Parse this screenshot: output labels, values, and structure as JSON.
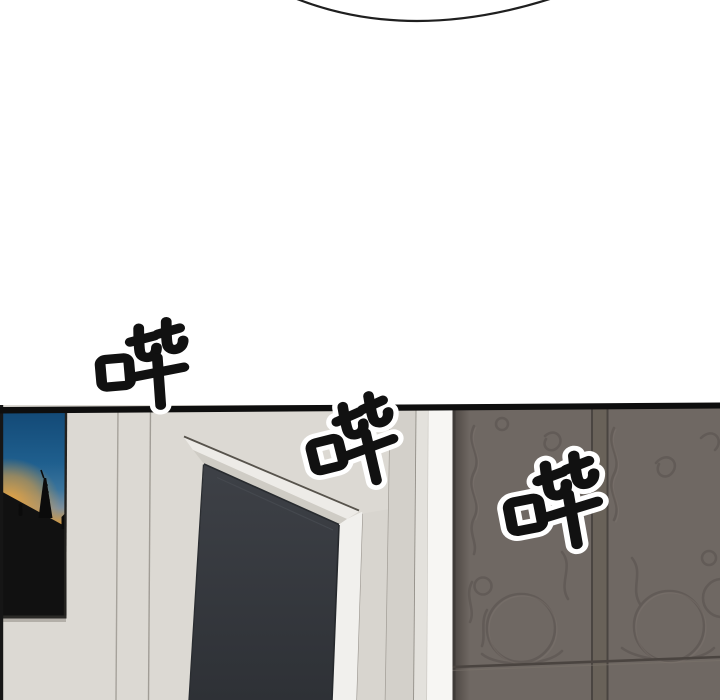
{
  "panel": {
    "type": "comic-panel",
    "sfx": [
      {
        "text": "哔"
      },
      {
        "text": "哔"
      },
      {
        "text": "哔"
      }
    ],
    "scene_objects": {
      "bubble": "speech-bubble-bottom-edge",
      "photo": "framed-sunset-oil-derrick-photo",
      "door": "dark-door-with-light-casing",
      "wardrobe": "ornate-two-door-wardrobe"
    },
    "colors": {
      "background": "#ffffff",
      "bubble_line": "#1f1f1f",
      "panel_border": "#0e0e0e",
      "wall": "#dcd9d3",
      "wall_shadow": "#d3d0ca",
      "door_casing_light": "#edebe7",
      "door_jamb_shadow": "#cfccc5",
      "door": "#35383d",
      "lit_strip": "#f7f6f3",
      "wardrobe": "#6f6863",
      "wardrobe_edge": "#3f3b38",
      "wardrobe_ornament": "#59524e",
      "photo_sky_deep": "#134a77",
      "photo_sky": "#2e6f9b",
      "photo_sunset": "#e8a238",
      "photo_hill": "#111111",
      "sfx_ink": "#111111",
      "sfx_outline": "#ffffff"
    }
  }
}
